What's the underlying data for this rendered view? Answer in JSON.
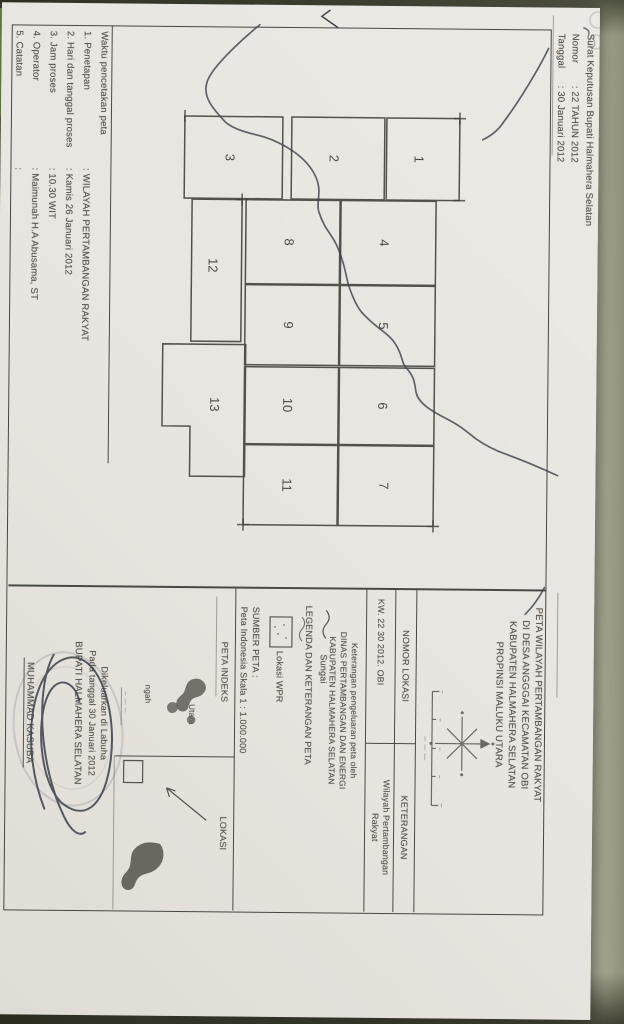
{
  "document": {
    "header": {
      "line1": "Surat Keputusan  Bupati Halmahera Selatan",
      "nomor_label": "Nomor",
      "nomor_value": ": 22 TAHUN 2012",
      "tanggal_label": "Tanggal",
      "tanggal_value": ": 30 Januari 2012"
    },
    "map": {
      "parcels": [
        "1",
        "2",
        "3",
        "4",
        "5",
        "6",
        "7",
        "8",
        "9",
        "10",
        "11",
        "12",
        "13"
      ]
    },
    "panel": {
      "title_lines": [
        "PETA WILAYAH PERTAMBANGAN RAKYAT",
        "DI DESA ANGGGAI KECAMATAN OBI",
        "KABUPATEN HALMAHERA SELATAN",
        "PROPINSI MALUKU UTARA"
      ],
      "table": {
        "col1_header": "NOMOR LOKASI",
        "col2_header": "KETERANGAN",
        "col1_value": "KW. 22 30 2012. OBI",
        "col2_value_line1": "Wilayah Pertambangan",
        "col2_value_line2": "Rakyat"
      },
      "note_lines": [
        "Keterangan pengeluaran peta oleh",
        "DINAS PERTAMBANGAN DAN ENERGI",
        "KABUPATEN HALMAHERA SELATAN"
      ],
      "legend": {
        "header": "LEGENDA DAN KETERANGAN PETA",
        "sungai_label": "Sungai",
        "wpr_label": "Lokasi WPR"
      },
      "sumber": {
        "label": "SUMBER PETA :",
        "value": "Peta Indonesia Skala 1 : 1.000.000"
      },
      "peta_indeks": {
        "header": "PETA INDEKS",
        "label_utara": "Utara",
        "label_tengah": "ngah"
      },
      "lokasi": {
        "header": "LOKASI"
      }
    },
    "footer": {
      "title": "Waktu pencetakan peta",
      "rows": [
        {
          "label": "1. Penetapan",
          "value": ": WILAYAH PERTAMBANGAN RAKYAT"
        },
        {
          "label": "2. Hari dan tanggal proses",
          "value": ": Kamis 26 Januari 2012"
        },
        {
          "label": "3. Jam proses",
          "value": ": 10.30 WIT"
        },
        {
          "label": "4. Operator",
          "value": ": Maimunah H.A  Abusama, ST"
        },
        {
          "label": "5. Catatan",
          "value": ":"
        }
      ]
    },
    "signature": {
      "line1": "Dikeluarkan di Labuha",
      "line2": "Pada tanggal 30 Januari 2012",
      "line3": "BUPATI HALMAHERA SELATAN",
      "name": "MUHAMMAD KASUBA"
    },
    "colors": {
      "background": "#82876c",
      "paper": "#e9e6e0",
      "ink": "#56534d",
      "line": "#474742",
      "pen": "#3e4450"
    }
  }
}
